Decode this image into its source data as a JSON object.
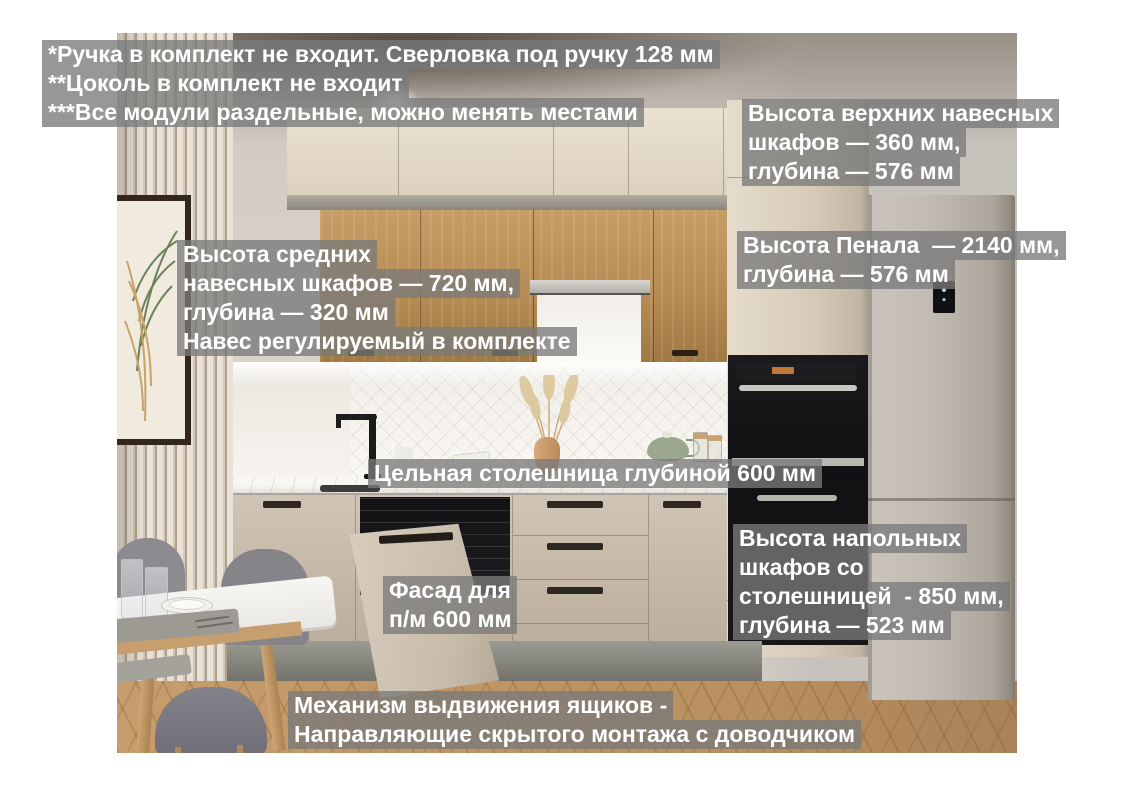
{
  "palette": {
    "overlay_gray": "#7a7a7a",
    "annotation_text": "#ffffff",
    "cabinet_cream": "#ddd2c0",
    "cabinet_oak": "#b58a52",
    "fridge_gray": "#bab4ac",
    "floor_wood": "#c09768"
  },
  "annotations": {
    "notes": {
      "lines": [
        "*Ручка в комплект не входит. Сверловка под ручку 128 мм",
        "**Цоколь в комплект не входит",
        "***Все модули раздельные, можно менять местами"
      ]
    },
    "upper_cabinets": {
      "lines": [
        "Высота верхних навесных",
        "шкафов — 360 мм,",
        "глубина — 576 мм"
      ]
    },
    "tall_cabinet": {
      "lines": [
        "Высота Пенала  — 2140 мм,",
        "глубина — 576 мм"
      ]
    },
    "middle_cabinets": {
      "lines": [
        "Высота средних",
        "навесных шкафов — 720 мм,",
        "глубина — 320 мм",
        "Навес регулируемый в комплекте"
      ]
    },
    "countertop": {
      "lines": [
        "Цельная столешница глубиной 600 мм"
      ]
    },
    "dishwasher_facade": {
      "lines": [
        "Фасад для",
        "п/м 600 мм"
      ]
    },
    "base_cabinets": {
      "lines": [
        "Высота напольных",
        "шкафов со",
        "столешницей  - 850 мм,",
        "глубина — 523 мм"
      ]
    },
    "drawer_mechanism": {
      "lines": [
        "Механизм выдвижения ящиков -",
        "Направляющие скрытого монтажа с доводчиком"
      ]
    }
  }
}
